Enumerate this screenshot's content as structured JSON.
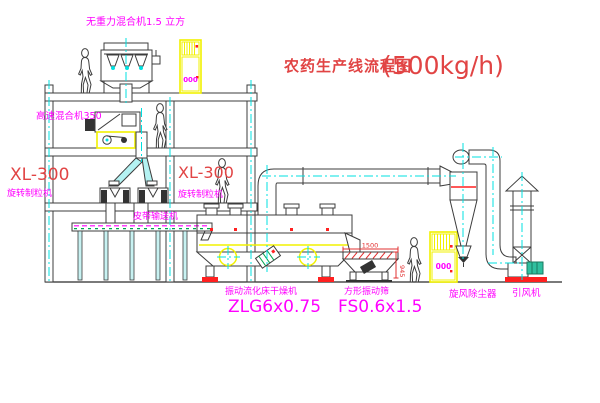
{
  "title": {
    "main": "农药生产线流程图",
    "capacity": "(500kg/h)"
  },
  "labels": {
    "gravity_mixer": "无重力混合机1.5 立方",
    "high_speed_mixer": "高速混合机350",
    "xl300_left": "XL-300",
    "granulator_left": "旋转制粒机",
    "xl300_right": "XL-300",
    "granulator_right": "旋转制粒机",
    "belt_conveyor": "皮带输送机",
    "dryer_name": "振动流化床干燥机",
    "dryer_model": "ZLG6x0.75",
    "screen_name": "方形振动筛",
    "screen_model": "FS0.6x1.5",
    "cyclone": "旋风除尘器",
    "fan": "引风机"
  },
  "dims": {
    "screen_length": "1500",
    "screen_height": "945"
  },
  "cabinet": {
    "display": "000"
  },
  "colors": {
    "background": "#ffffff",
    "line": "#3c3c3c",
    "label_magenta": "#ff00ff",
    "label_red": "#e14444",
    "equipment_yellow": "#f2f200",
    "centerline_cyan": "#00e0e0",
    "belt_green": "#00a550",
    "base_red": "#ff2020"
  }
}
